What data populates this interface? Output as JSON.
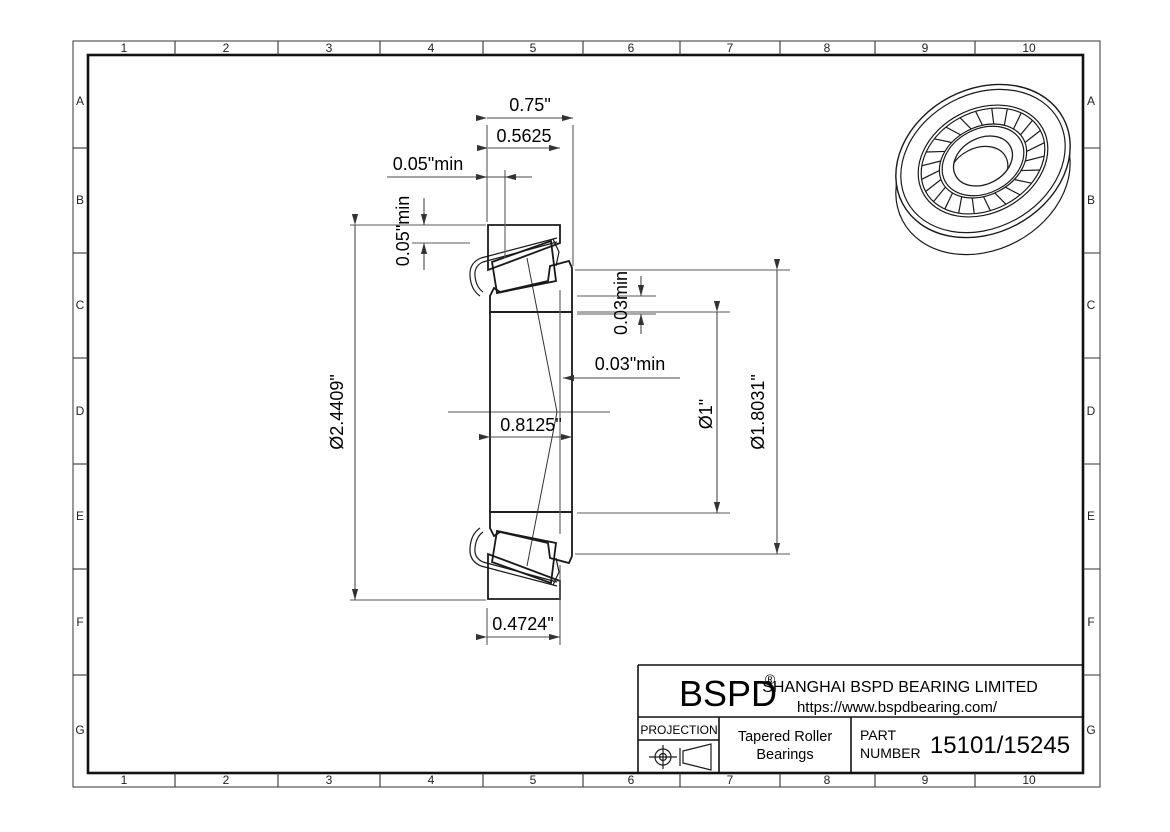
{
  "grid": {
    "cols": [
      "1",
      "2",
      "3",
      "4",
      "5",
      "6",
      "7",
      "8",
      "9",
      "10"
    ],
    "rows": [
      "A",
      "B",
      "C",
      "D",
      "E",
      "F",
      "G"
    ]
  },
  "dimensions": {
    "overall_width": "0.75\"",
    "cup_width": "0.5625",
    "front_clearance": "0.05\"min",
    "radial_clearance": "0.05\"min",
    "outer_diameter": "Ø2.4409\"",
    "rib_clearance": "0.03min",
    "back_clearance": "0.03\"min",
    "cone_width": "0.8125\"",
    "bore_diameter": "Ø1\"",
    "cup_race_diameter": "Ø1.8031\"",
    "cup_front_width": "0.4724\""
  },
  "title_block": {
    "brand": "BSPD",
    "registered": "®",
    "company": "SHANGHAI BSPD BEARING LIMITED",
    "website": "https://www.bspdbearing.com/",
    "projection_label": "PROJECTION",
    "product_line1": "Tapered Roller",
    "product_line2": "Bearings",
    "part_label_line1": "PART",
    "part_label_line2": "NUMBER",
    "part_number": "15101/15245"
  }
}
